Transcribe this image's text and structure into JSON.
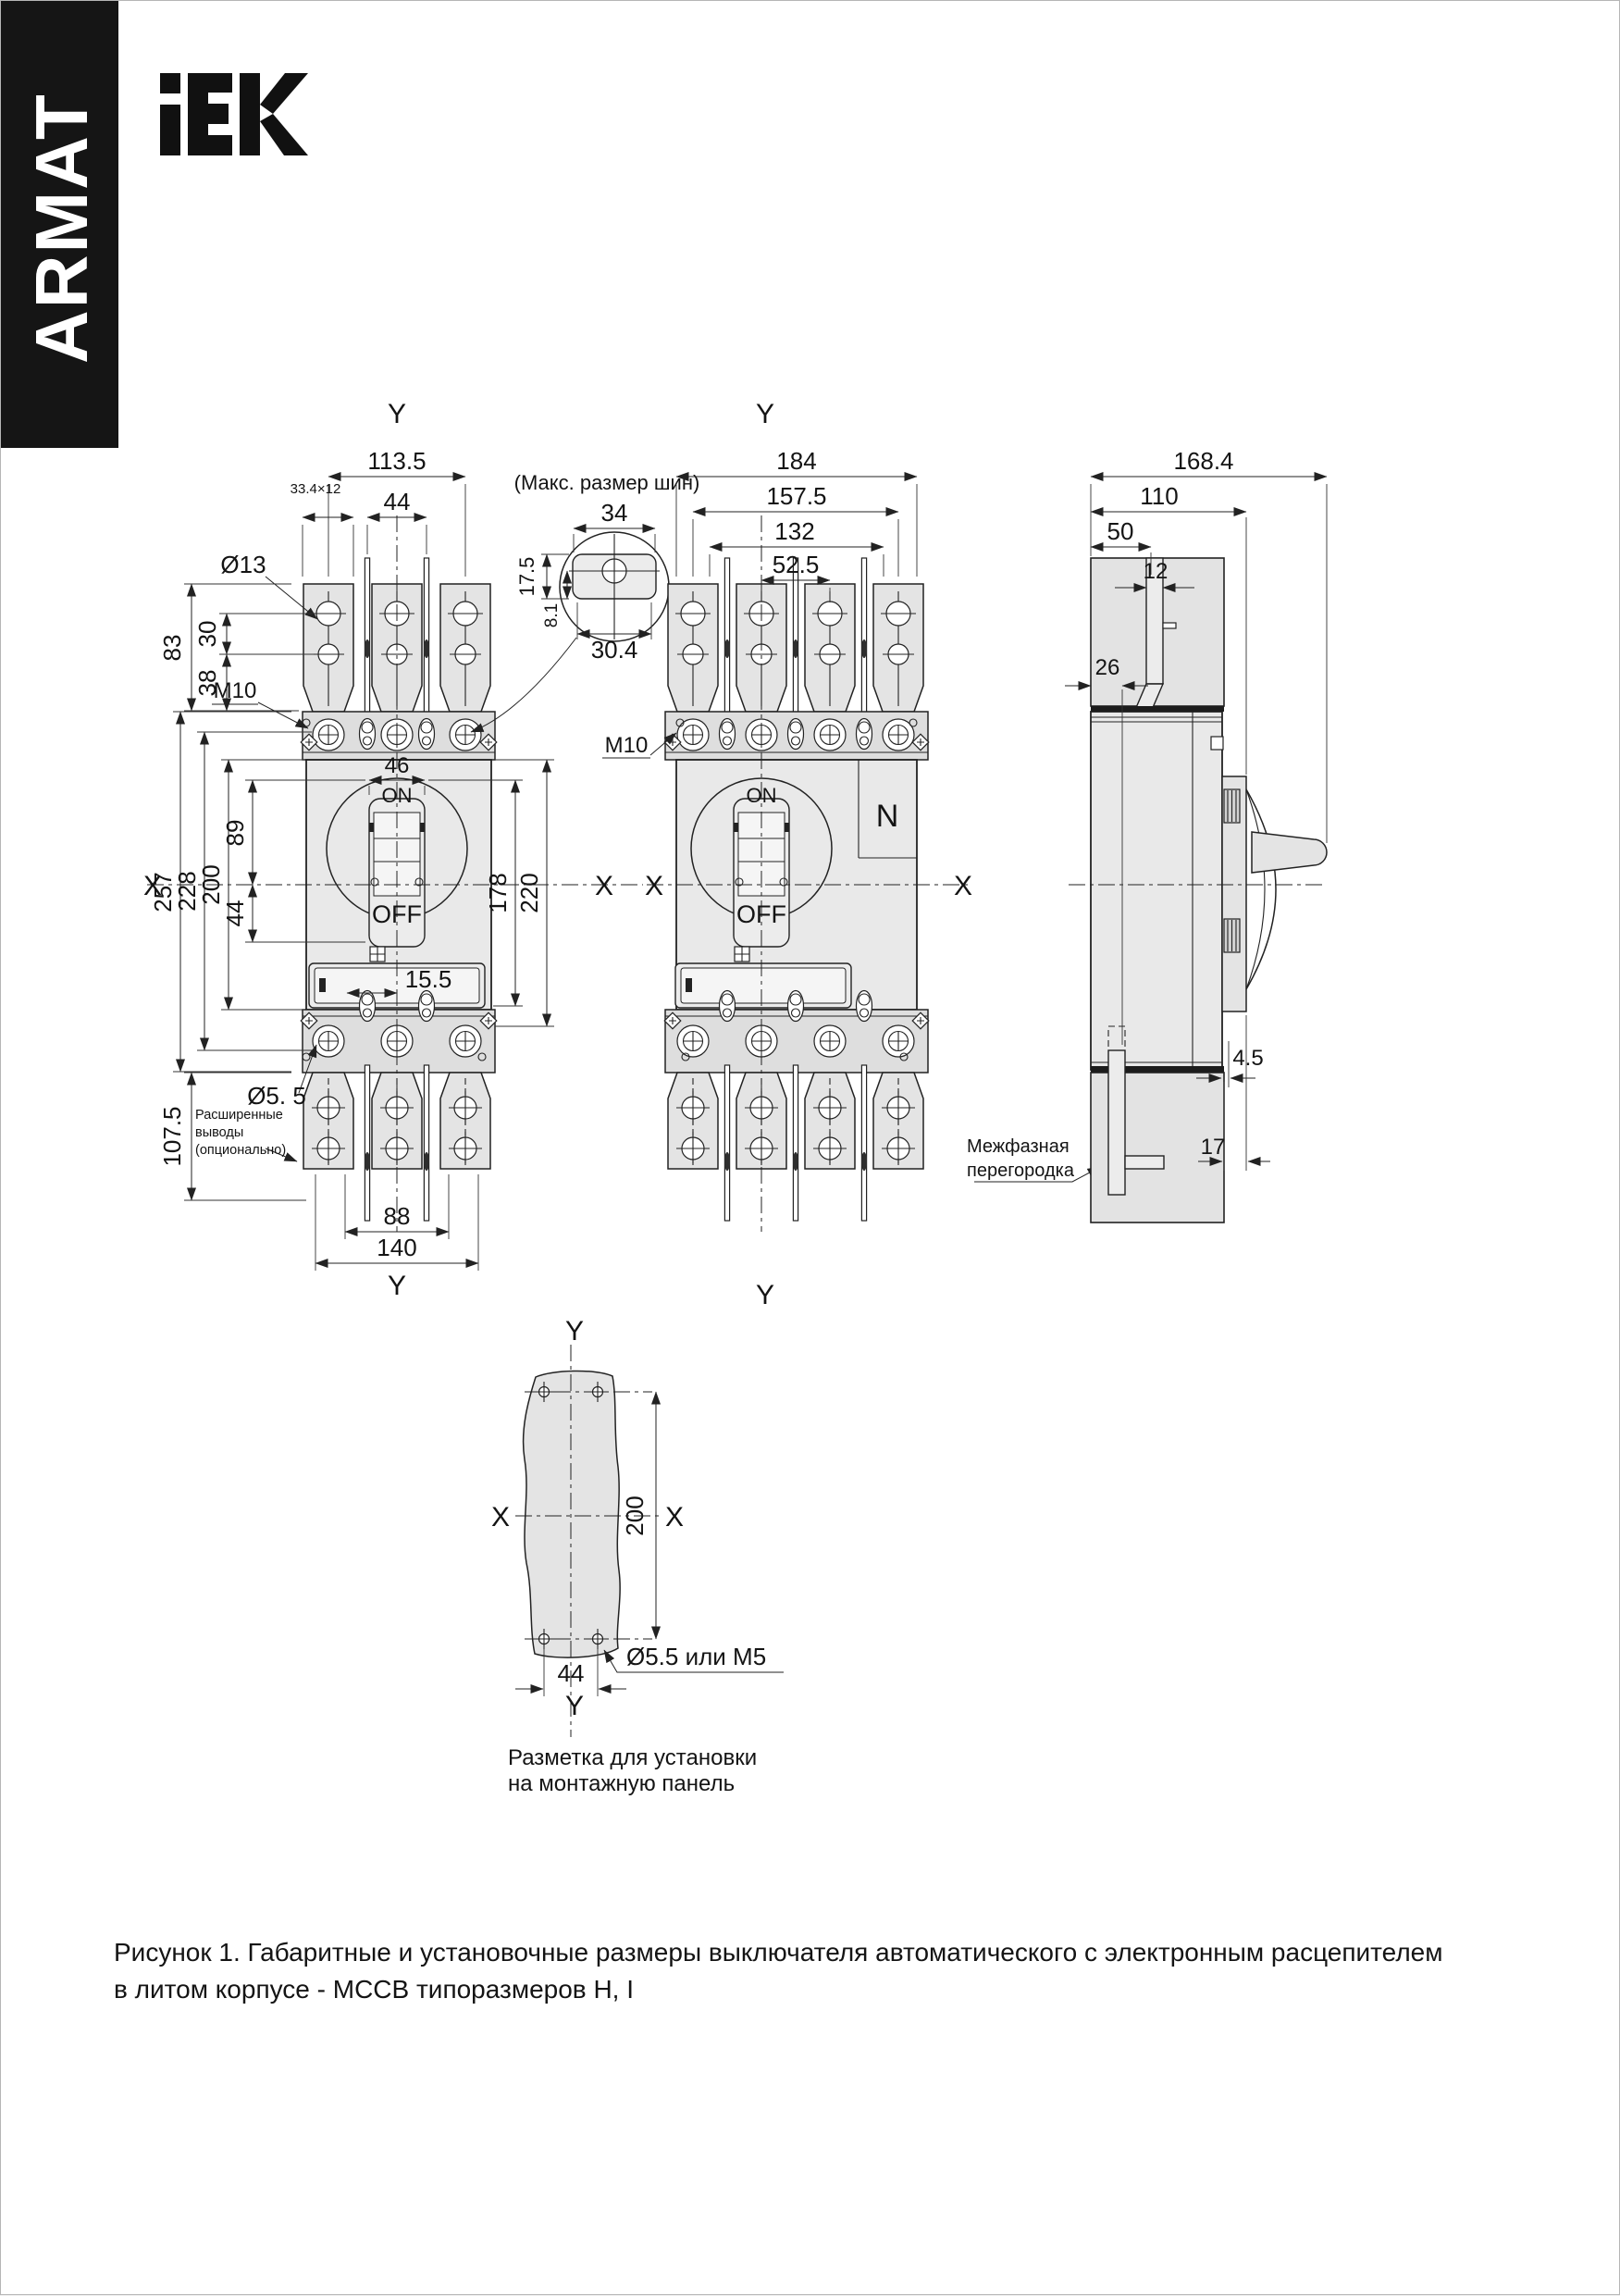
{
  "colors": {
    "banner_bg": "#151515",
    "banner_text": "#ffffff",
    "logo": "#111111",
    "line": "#222222",
    "body_fill": "#e9e9e9",
    "page_bg": "#ffffff"
  },
  "brand": {
    "armat": "ARMAT",
    "iek": "iEK"
  },
  "v1": {
    "y_top": "Y",
    "y_bottom": "Y",
    "x_left": "X",
    "x_right": "X",
    "d113_5": "113.5",
    "d44_top": "44",
    "d33x12": "33.4×12",
    "dia13": "Ø13",
    "d83": "83",
    "d30": "30",
    "d38": "38",
    "m10": "M10",
    "d257": "257",
    "d228": "228",
    "d200": "200",
    "d89": "89",
    "d44_left": "44",
    "d46": "46",
    "on": "ON",
    "off": "OFF",
    "d15_5": "15.5",
    "d178": "178",
    "d220": "220",
    "dia5_5": "Ø5. 5",
    "d107_5": "107.5",
    "note_l1": "Расширенные",
    "note_l2": "выводы",
    "note_l3": "(опционально)",
    "d88": "88",
    "d140": "140"
  },
  "detail": {
    "title": "(Макс. размер шин)",
    "d34": "34",
    "d17_5": "17.5",
    "d8_1": "8.1",
    "d30_4": "30.4"
  },
  "v2": {
    "y_top": "Y",
    "y_bottom": "Y",
    "x_left": "X",
    "x_right": "X",
    "d184": "184",
    "d157_5": "157.5",
    "d132": "132",
    "d52_5": "52.5",
    "m10": "M10",
    "n_label": "N",
    "on": "ON",
    "off": "OFF",
    "part_l1": "Межфазная",
    "part_l2": "перегородка"
  },
  "v3": {
    "d168_4": "168.4",
    "d110": "110",
    "d50": "50",
    "d12": "12",
    "d26": "26",
    "d4_5": "4.5",
    "d17": "17"
  },
  "v4": {
    "y_top": "Y",
    "y_bottom": "Y",
    "x_left": "X",
    "x_right": "X",
    "d200": "200",
    "d44": "44",
    "hole_note": "Ø5.5 или M5",
    "cap_l1": "Разметка для установки",
    "cap_l2": "на монтажную панель"
  },
  "caption": {
    "line1": "Рисунок 1. Габаритные и установочные размеры выключателя автоматического с электронным расцепителем",
    "line2": "в литом корпусе - MCCB типоразмеров H, I"
  }
}
